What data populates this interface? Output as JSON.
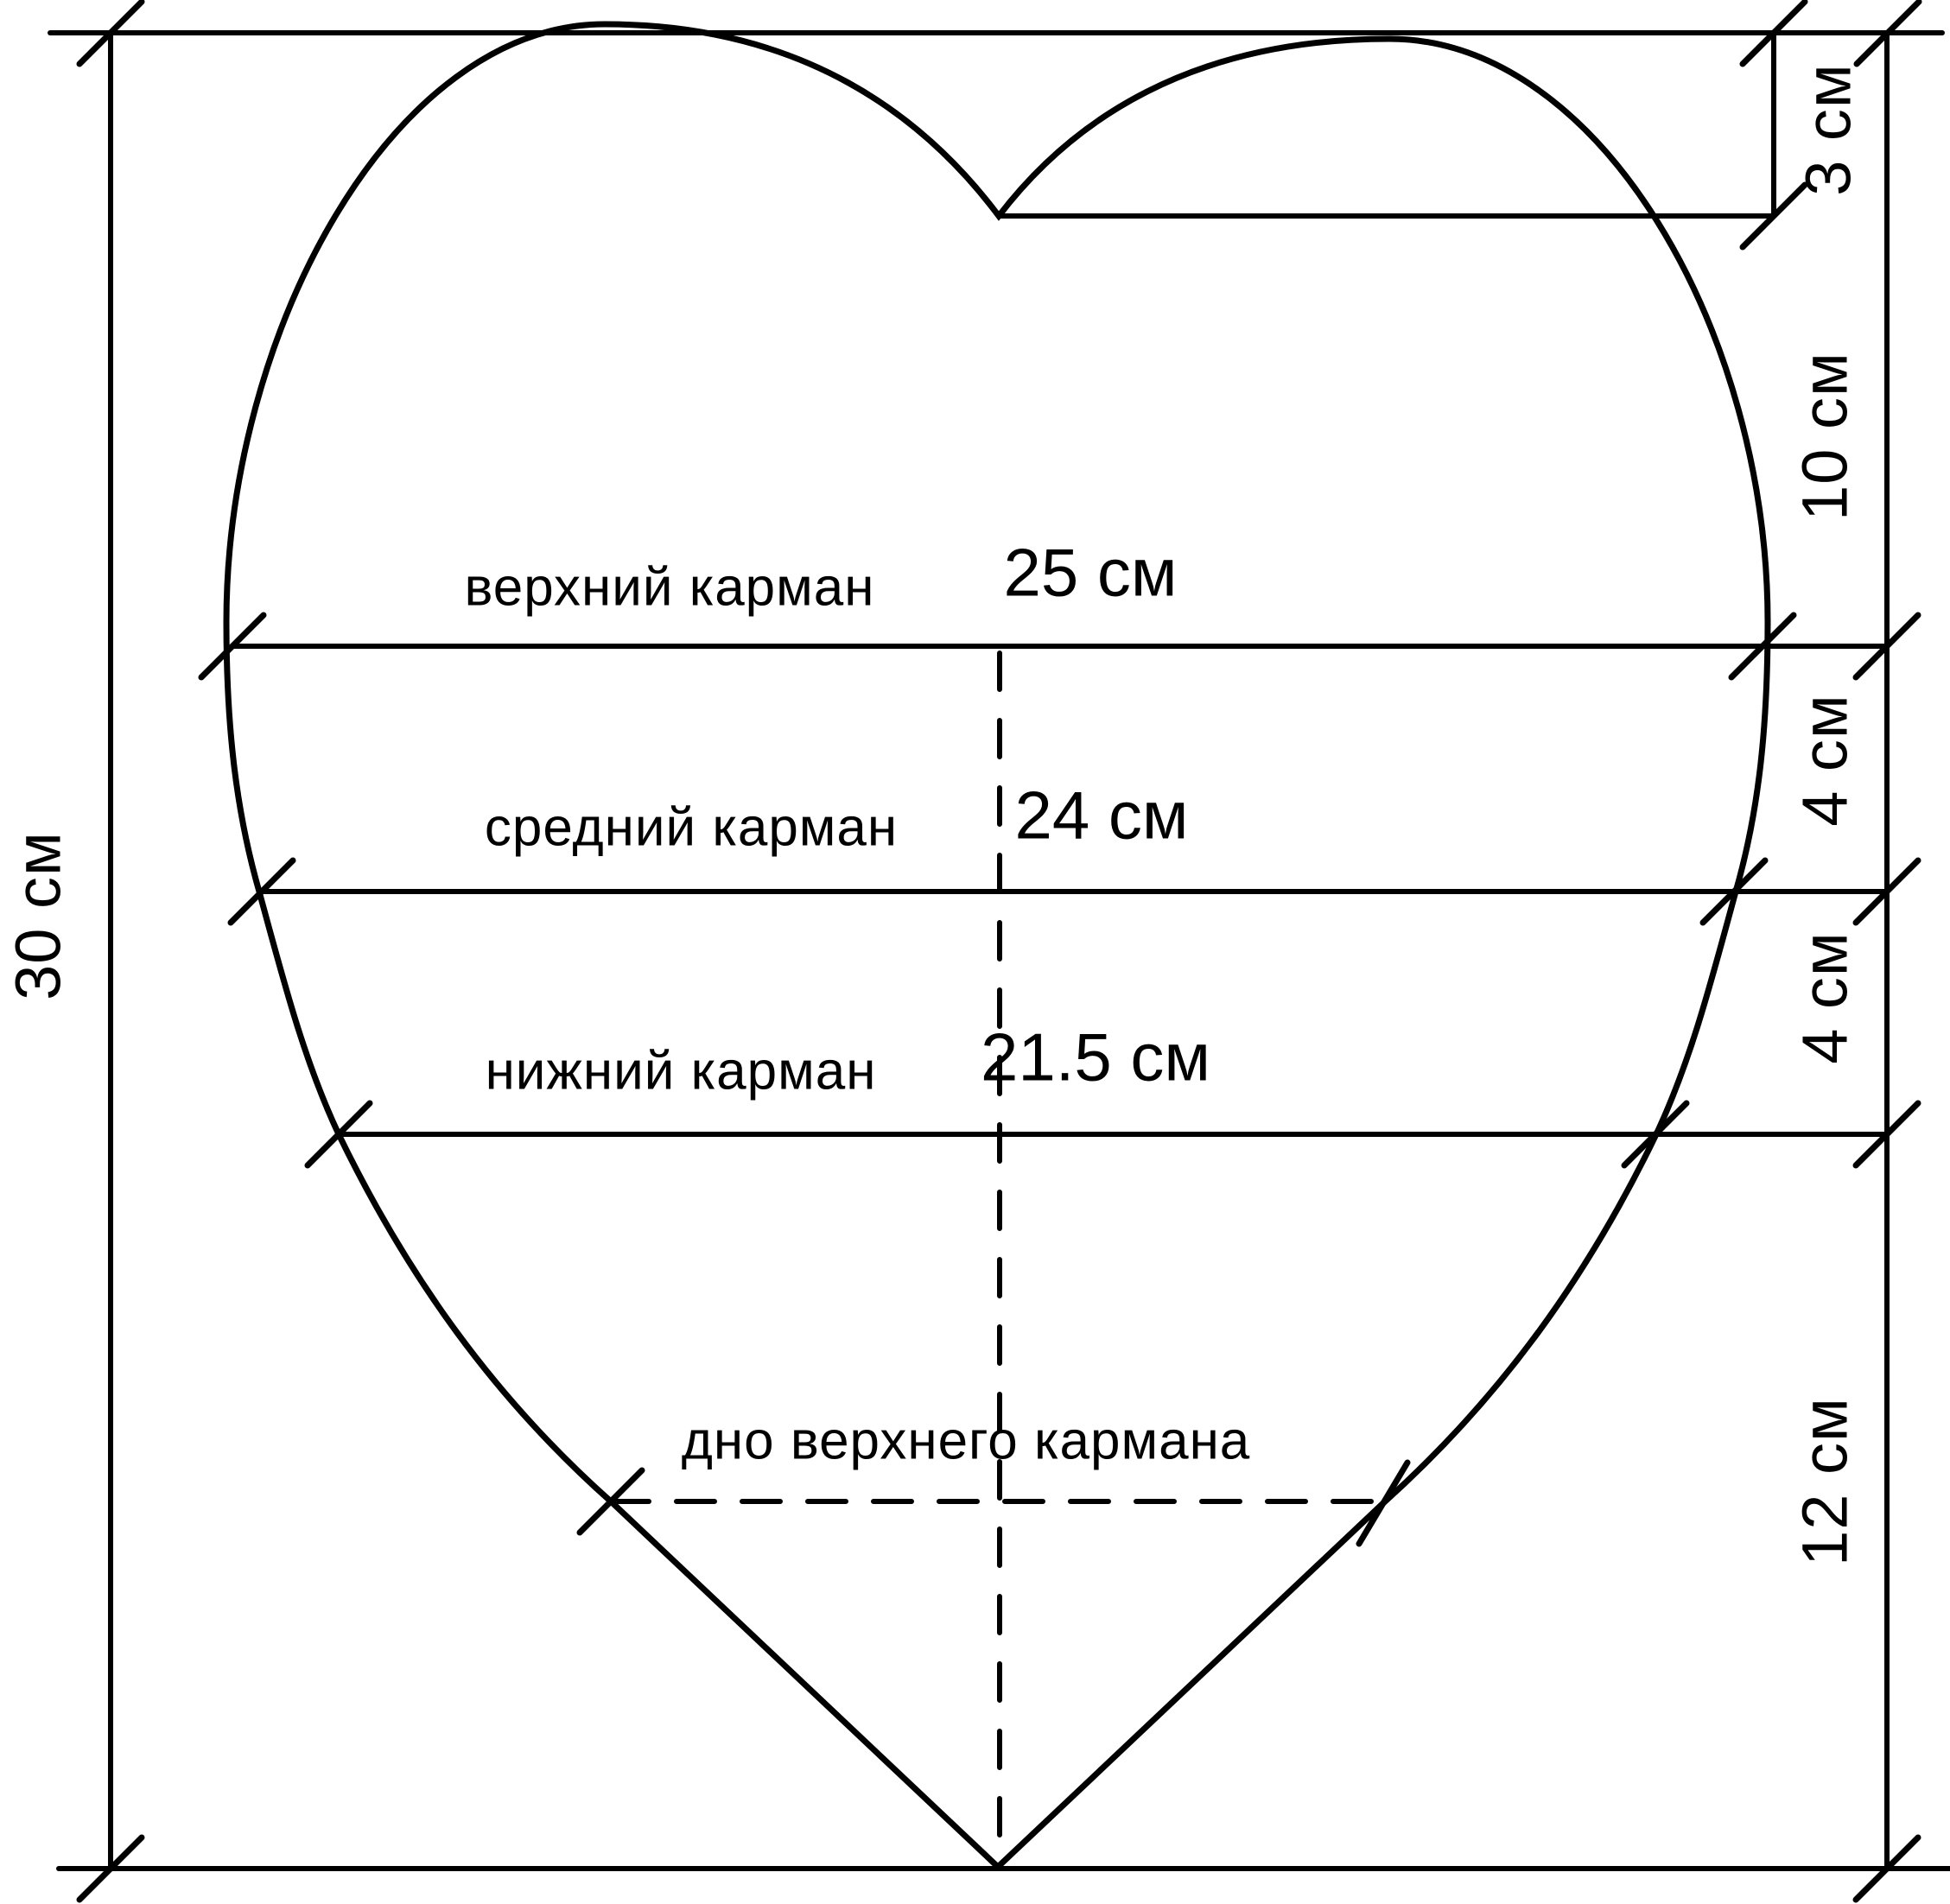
{
  "diagram": {
    "type": "sewing-pattern",
    "shape": "heart",
    "pockets": [
      {
        "label": "верхний карман",
        "width": "25 см"
      },
      {
        "label": "средний карман",
        "width": "24 см"
      },
      {
        "label": "нижний карман",
        "width": "21.5 см"
      }
    ],
    "annotation": "дно верхнего кармана",
    "left_dimension": "30 см",
    "right_dimensions": [
      "3 см",
      "10 см",
      "4 см",
      "4 см",
      "12 см"
    ],
    "colors": {
      "line": "#000000",
      "background": "#ffffff"
    }
  }
}
